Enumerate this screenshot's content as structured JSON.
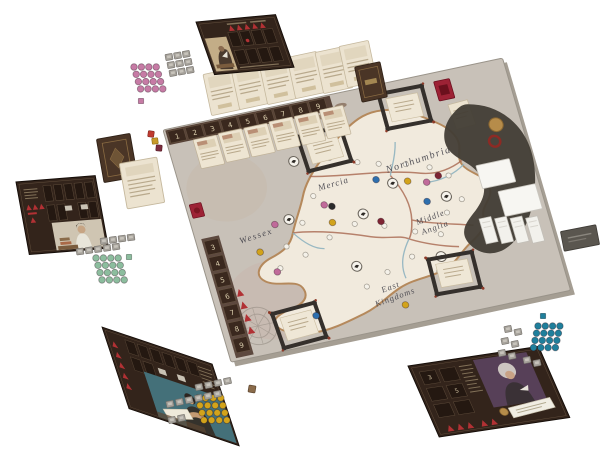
{
  "scene": {
    "background": "#ffffff"
  },
  "colors": {
    "board_surface": "#c8c1b8",
    "board_edge": "#a59e93",
    "land": "#f1eadd",
    "coast": "#b5895c",
    "region_border": "#a8674f",
    "river": "#8fb3c0",
    "frame_dark": "#35302c",
    "parchment": "#efe7d6",
    "card_back_brown": "#4a3526",
    "player_board_brown": "#33241b",
    "red_piece": "#b13134",
    "red_tile": "#9d2235",
    "tile_grey": "#a5a19a",
    "victory_tile_grey": "#5a564f",
    "creature_dark": "#423d35",
    "gold": "#b68c4a",
    "die_red": "#c03b30",
    "die_yellow": "#c89b2a",
    "die_maroon": "#7c2d3e",
    "die_brown": "#8a6b4a"
  },
  "board": {
    "regions": {
      "northumbria": "Northumbria",
      "mercia": "Mercia",
      "wessex": "Wessex",
      "middle_anglia_line1": "Middle",
      "middle_anglia_line2": "Anglia",
      "east_kingdoms_line1": "East",
      "east_kingdoms_line2": "Kingdoms"
    },
    "top_track_numbers": [
      "1",
      "2",
      "3",
      "4",
      "5",
      "6",
      "7",
      "8",
      "9"
    ],
    "left_track_numbers": [
      "3",
      "4",
      "5",
      "6",
      "7",
      "8",
      "9"
    ],
    "card_slots_count": 4
  },
  "players": [
    {
      "color_name": "pink",
      "disc_color": "#c67ba5",
      "disc_count": 16,
      "has_cube": true,
      "board_position": "top-left"
    },
    {
      "color_name": "green",
      "disc_color": "#8cbd9e",
      "disc_count": 16,
      "has_cube": true,
      "board_position": "left"
    },
    {
      "color_name": "yellow",
      "disc_color": "#d2a31b",
      "disc_count": 16,
      "has_die": true,
      "board_position": "bottom-left"
    },
    {
      "color_name": "teal",
      "disc_color": "#1f7f9c",
      "disc_count": 16,
      "has_cube": true,
      "board_position": "bottom-right"
    }
  ],
  "map_token_colors": {
    "pink": "#c06a9a",
    "yellow": "#d2a31b",
    "blue": "#2e6fae",
    "black": "#2b2b2b",
    "dark_red": "#7e2433"
  },
  "card_rows": {
    "upper_count": 6,
    "lower_count": 6
  },
  "br_slot_numbers": [
    "3",
    "5"
  ]
}
